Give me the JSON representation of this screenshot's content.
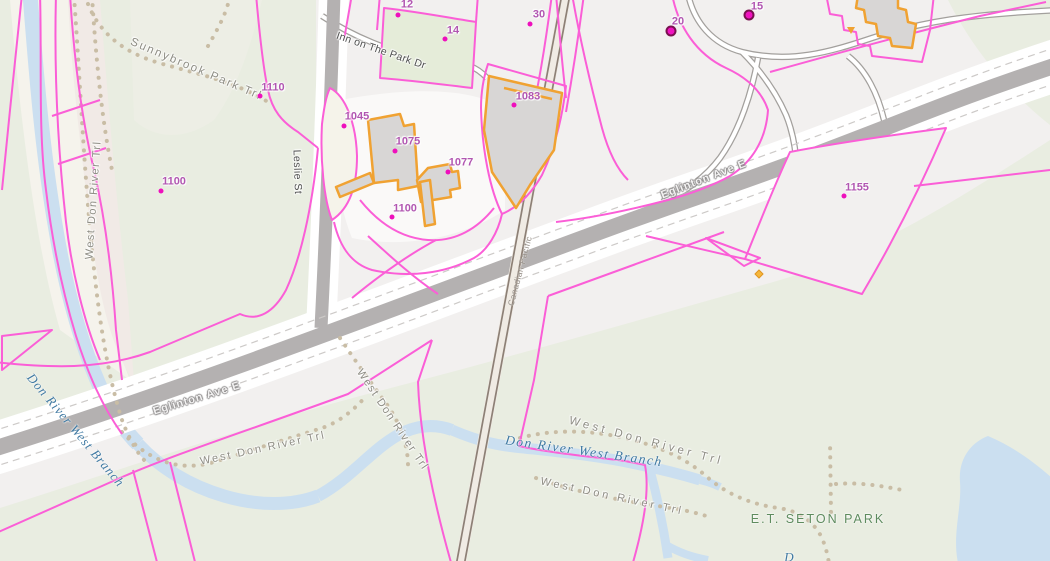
{
  "map": {
    "title": "Toronto parcel / property map — Leslie St & Eglinton Ave E",
    "colors": {
      "background_urban": "#f2f0ef",
      "background_park": "#e9ede1",
      "parcel_line_magenta": "#fb5ed7",
      "building_outline_orange": "#f0a232",
      "building_fill_gray": "#d8d6d5",
      "road_core_gray": "#b4b1b1",
      "water_blue": "#cbdff0",
      "railway_brown": "#8d8076",
      "trail_dot_tan": "#c9bda5",
      "address_text_purple": "#b156b1",
      "address_dot_magenta": "#ee10bc",
      "water_label_blue": "#3f79a2",
      "park_label_green": "#5e8b5e"
    },
    "labels": [
      {
        "text": "Sunnybrook Park Trl",
        "x": 196,
        "y": 70,
        "rot": 23,
        "cls": "trail",
        "ls": 2,
        "fs": 11.5
      },
      {
        "text": "West Don River Trl",
        "x": 94,
        "y": 200,
        "rot": -86,
        "cls": "trail",
        "ls": 1.5,
        "fs": 11
      },
      {
        "text": "Leslie St",
        "x": 297,
        "y": 172,
        "rot": 88,
        "cls": "street",
        "ls": 0.5,
        "fs": 10.5
      },
      {
        "text": "Inn on The Park Dr",
        "x": 381,
        "y": 51,
        "rot": 19,
        "cls": "street",
        "ls": 0.3,
        "fs": 10.5
      },
      {
        "text": "Eglinton Ave E",
        "x": 704,
        "y": 180,
        "rot": -21,
        "cls": "onroad",
        "ls": 1,
        "fs": 11
      },
      {
        "text": "Eglinton Ave E",
        "x": 197,
        "y": 399,
        "rot": -17,
        "cls": "onroad",
        "ls": 1,
        "fs": 11
      },
      {
        "text": "Canadian Pacific",
        "x": 520,
        "y": 271,
        "rot": -75,
        "cls": "rail",
        "ls": 0.5,
        "fs": 8.5
      },
      {
        "text": "West Don River Trl",
        "x": 263,
        "y": 449,
        "rot": -12,
        "cls": "trail",
        "ls": 2,
        "fs": 11
      },
      {
        "text": "West Don River Trl",
        "x": 392,
        "y": 420,
        "rot": 56,
        "cls": "trail",
        "ls": 1.5,
        "fs": 11
      },
      {
        "text": "West Don River Trl",
        "x": 646,
        "y": 442,
        "rot": 15,
        "cls": "trail",
        "ls": 3.5,
        "fs": 11.5
      },
      {
        "text": "West Don River Trl",
        "x": 612,
        "y": 497,
        "rot": 12,
        "cls": "trail",
        "ls": 3,
        "fs": 11
      },
      {
        "text": "Don River West Branch",
        "x": 76,
        "y": 430,
        "rot": 50,
        "cls": "water",
        "ls": 1,
        "fs": 13
      },
      {
        "text": "Don River West Branch",
        "x": 584,
        "y": 451,
        "rot": 8,
        "cls": "water",
        "ls": 1.5,
        "fs": 13.5
      },
      {
        "text": "E.T. SETON PARK",
        "x": 818,
        "y": 519,
        "rot": 0,
        "cls": "park",
        "ls": 2,
        "fs": 12.5
      },
      {
        "text": "D",
        "x": 789,
        "y": 557,
        "rot": 0,
        "cls": "water",
        "ls": 0,
        "fs": 13
      }
    ],
    "addresses": [
      {
        "number": "12",
        "tx": 407,
        "ty": 5,
        "dx": 398,
        "dy": 15,
        "ring": false
      },
      {
        "number": "14",
        "tx": 453,
        "ty": 31,
        "dx": 445,
        "dy": 39,
        "ring": false
      },
      {
        "number": "30",
        "tx": 539,
        "ty": 15,
        "dx": 530,
        "dy": 24,
        "ring": false
      },
      {
        "number": "20",
        "tx": 678,
        "ty": 22,
        "dx": 671,
        "dy": 31,
        "ring": true
      },
      {
        "number": "15",
        "tx": 757,
        "ty": 7,
        "dx": 749,
        "dy": 15,
        "ring": true
      },
      {
        "number": "1110",
        "tx": 273,
        "ty": 88,
        "dx": 260,
        "dy": 96,
        "ring": false
      },
      {
        "number": "1100",
        "tx": 174,
        "ty": 182,
        "dx": 161,
        "dy": 191,
        "ring": false
      },
      {
        "number": "1045",
        "tx": 357,
        "ty": 117,
        "dx": 344,
        "dy": 126,
        "ring": false
      },
      {
        "number": "1075",
        "tx": 408,
        "ty": 142,
        "dx": 395,
        "dy": 151,
        "ring": false
      },
      {
        "number": "1077",
        "tx": 461,
        "ty": 163,
        "dx": 448,
        "dy": 172,
        "ring": false
      },
      {
        "number": "1083",
        "tx": 528,
        "ty": 97,
        "dx": 514,
        "dy": 105,
        "ring": false
      },
      {
        "number": "1100",
        "tx": 405,
        "ty": 209,
        "dx": 392,
        "dy": 217,
        "ring": false
      },
      {
        "number": "1155",
        "tx": 857,
        "ty": 188,
        "dx": 844,
        "dy": 196,
        "ring": false
      }
    ]
  }
}
